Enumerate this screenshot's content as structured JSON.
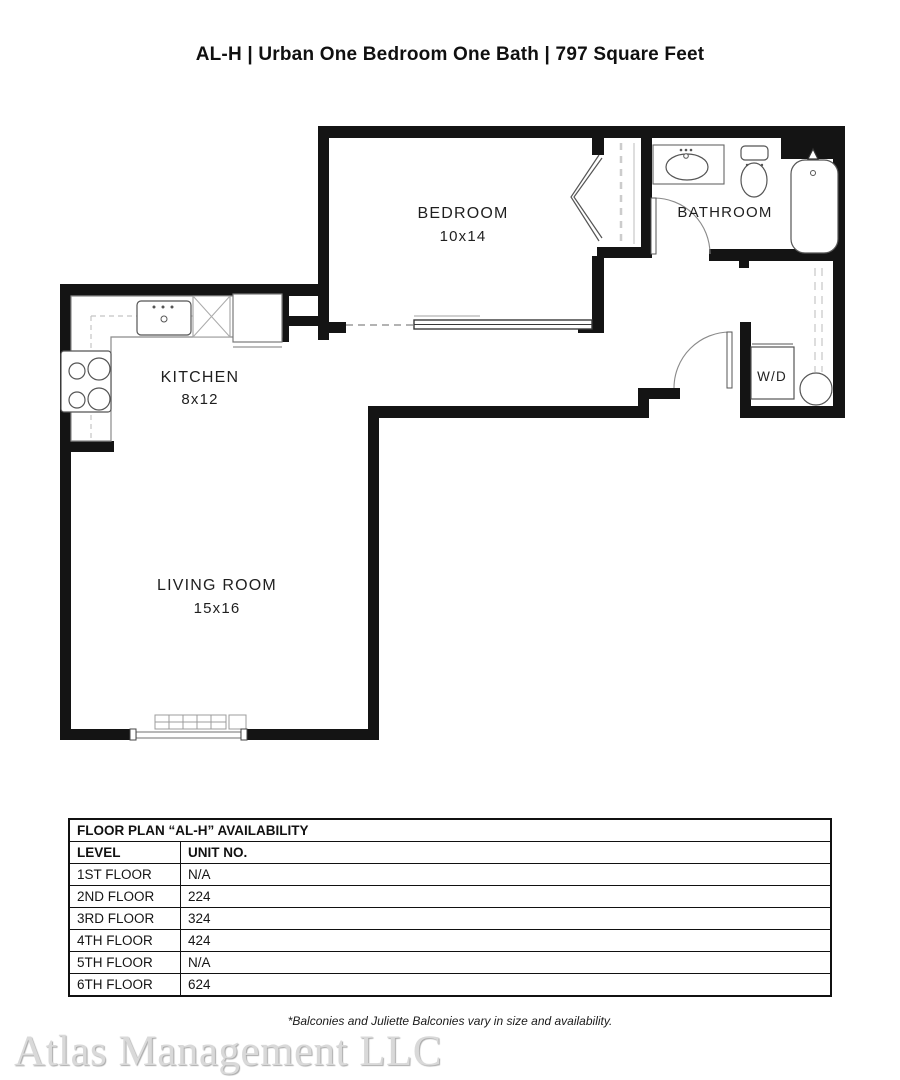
{
  "title": "AL-H | Urban One Bedroom One Bath | 797 Square Feet",
  "plan": {
    "rooms": {
      "bedroom": {
        "label": "BEDROOM",
        "dims": "10x14"
      },
      "bathroom": {
        "label": "BATHROOM",
        "dims": ""
      },
      "kitchen": {
        "label": "KITCHEN",
        "dims": "8x12"
      },
      "living_room": {
        "label": "LIVING ROOM",
        "dims": "15x16"
      },
      "laundry": {
        "label": "W/D",
        "dims": ""
      }
    }
  },
  "availability": {
    "title": "FLOOR PLAN “AL-H” AVAILABILITY",
    "columns": {
      "level": "LEVEL",
      "unit": "UNIT NO."
    },
    "rows": [
      {
        "level": "1ST FLOOR",
        "unit": "N/A"
      },
      {
        "level": "2ND FLOOR",
        "unit": "224"
      },
      {
        "level": "3RD FLOOR",
        "unit": "324"
      },
      {
        "level": "4TH FLOOR",
        "unit": "424"
      },
      {
        "level": "5TH FLOOR",
        "unit": "N/A"
      },
      {
        "level": "6TH FLOOR",
        "unit": "624"
      }
    ]
  },
  "footnote": "*Balconies and Juliette Balconies vary in size and availability.",
  "watermark": "Atlas Management LLC",
  "colors": {
    "wall": "#141414",
    "fixture_line": "#555555",
    "watermark_gray": "#d9d9d9"
  }
}
